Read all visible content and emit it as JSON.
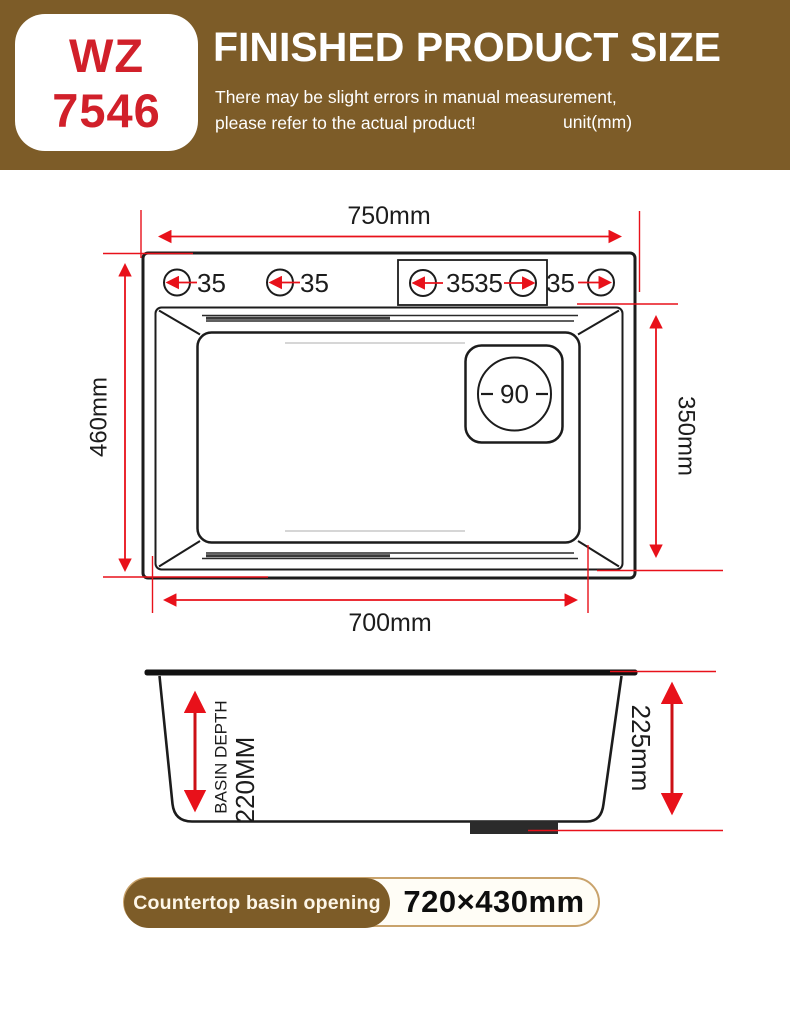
{
  "header": {
    "model": {
      "line1": "WZ",
      "line2": "7546"
    },
    "title": "FINISHED PRODUCT SIZE",
    "subtitle_line1": "There may be slight errors in manual measurement,",
    "subtitle_line2": "please refer to the actual product!",
    "unit_note": "unit(mm)"
  },
  "top_view": {
    "overall_width": "750mm",
    "overall_depth": "460mm",
    "inner_width": "700mm",
    "inner_depth": "350mm",
    "faucet_holes": [
      "35",
      "35",
      "35",
      "35",
      "35"
    ],
    "drain_diameter": "90"
  },
  "side_view": {
    "basin_depth_line1": "BASIN DEPTH",
    "basin_depth_line2": "220MM",
    "overall_height": "225mm"
  },
  "footer": {
    "badge_label": "Countertop basin opening",
    "badge_value": "720×430mm"
  },
  "colors": {
    "header_brown": "#7d5c28",
    "accent_red": "#d1202a",
    "dimension_red": "#e8111a",
    "line_black": "#1c1c1c"
  }
}
